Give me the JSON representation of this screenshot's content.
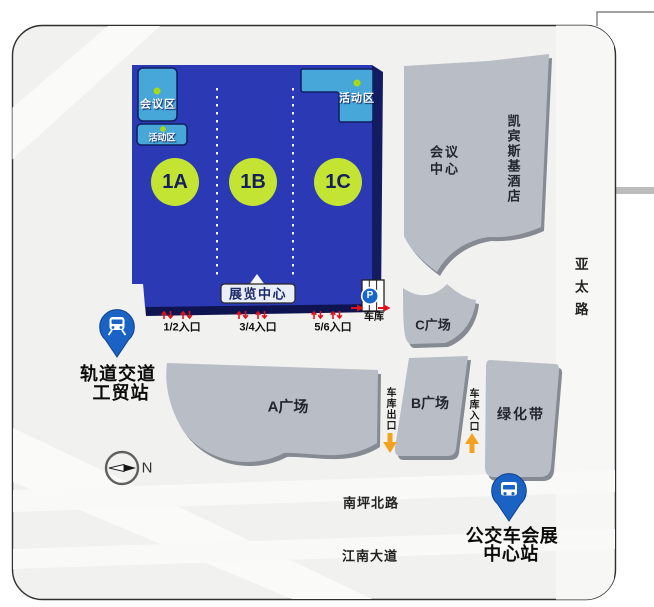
{
  "map": {
    "exhibition_hall": {
      "label": "展览中心",
      "sections": [
        {
          "id": "1A"
        },
        {
          "id": "1B"
        },
        {
          "id": "1C"
        }
      ],
      "meeting_area": {
        "label": "会议区"
      },
      "activity_area_left": {
        "label": "活动区"
      },
      "activity_area_right": {
        "label": "活动区"
      }
    },
    "entrances": [
      {
        "label": "1/2入口"
      },
      {
        "label": "3/4入口"
      },
      {
        "label": "5/6入口"
      }
    ],
    "parking": {
      "symbol": "P",
      "label": "车库"
    },
    "buildings": {
      "conference_center": {
        "label_line1": "会议",
        "label_line2": "中心"
      },
      "hotel": {
        "label": "凯宾斯基酒店"
      }
    },
    "plazas": {
      "a": {
        "label": "A广场"
      },
      "b": {
        "label": "B广场"
      },
      "c": {
        "label": "C广场"
      },
      "green_belt": {
        "label": "绿化带"
      }
    },
    "garage": {
      "exit": {
        "label": "车库出口"
      },
      "entrance": {
        "label": "车库入口"
      }
    },
    "stations": {
      "metro": {
        "line1": "轨道交道",
        "line2": "工贸站"
      },
      "bus": {
        "line1": "公交车会展",
        "line2": "中心站"
      }
    },
    "roads": {
      "yatai": {
        "label": "亚太路"
      },
      "nanping_north": {
        "label": "南坪北路"
      },
      "jiangnan": {
        "label": "江南大道"
      }
    },
    "compass": {
      "label": "N"
    }
  },
  "icons": {
    "metro_pin": "train-icon",
    "bus_pin": "bus-icon",
    "parking_sign": "parking-icon",
    "compass": "compass-icon",
    "entrance_flow": "up-down-arrows-icon",
    "garage_exit_flow": "down-arrow-icon",
    "garage_entrance_flow": "up-arrow-icon"
  },
  "colors": {
    "hall_blue": "#2b3ab4",
    "hall_edge_navy": "#0d1450",
    "area_light_blue": "#47a7d8",
    "section_circle_green": "#c3e432",
    "section_text_navy": "#17205e",
    "building_gray": "#b9bdc6",
    "building_shadow": "#868a93",
    "pin_blue": "#1a63c5",
    "arrow_orange": "#f5a120",
    "arrow_red": "#e0111a",
    "map_background": "#f1f1ef"
  }
}
